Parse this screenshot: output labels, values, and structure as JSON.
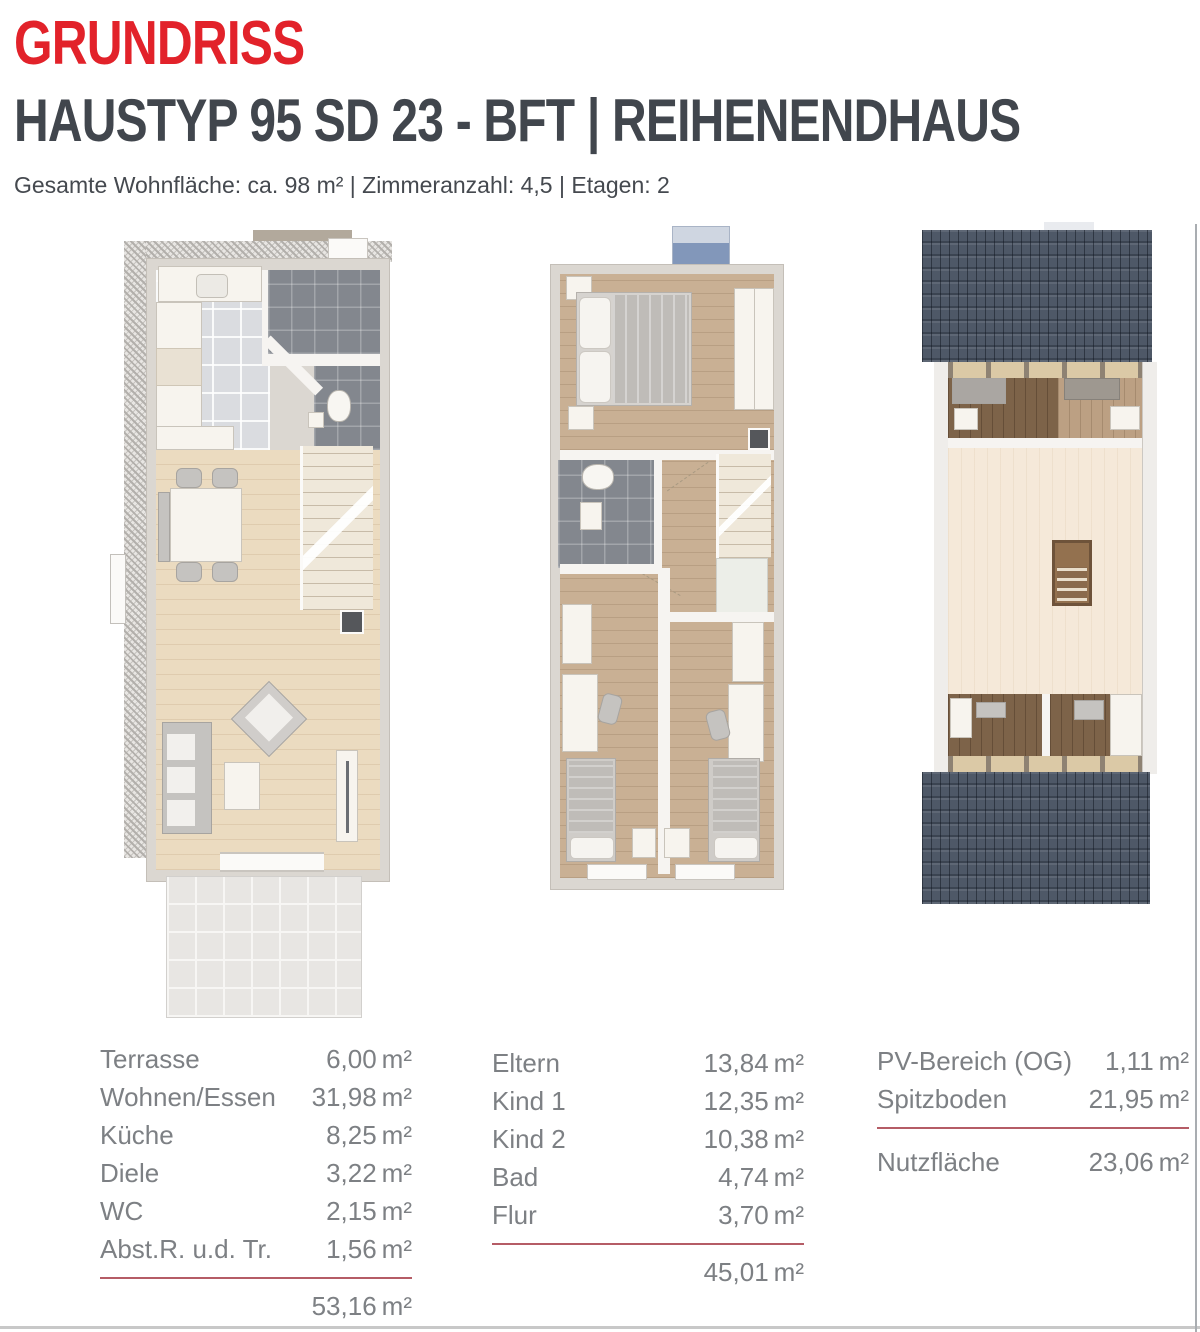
{
  "header": {
    "eyebrow": "GRUNDRISS",
    "title": "HAUSTYP 95 SD 23 - BFT | REIHENENDHAUS",
    "meta": "Gesamte Wohnfläche: ca. 98 m² | Zimmeranzahl: 4,5 | Etagen: 2"
  },
  "unit": "m²",
  "colors": {
    "accent_red": "#e2222a",
    "title_gray": "#41464d",
    "table_text": "#7d8084",
    "rule_red": "#b55c66",
    "roof_blue_gray": "#4e5867",
    "wood_light": "#ebdbc0",
    "wood_medium": "#c9b094",
    "tile_dark": "#83878e"
  },
  "tables": {
    "erdgeschoss": {
      "rows": [
        {
          "label": "Terrasse",
          "value": "6,00"
        },
        {
          "label": "Wohnen/Essen",
          "value": "31,98"
        },
        {
          "label": "Küche",
          "value": "8,25"
        },
        {
          "label": "Diele",
          "value": "3,22"
        },
        {
          "label": "WC",
          "value": "2,15"
        },
        {
          "label": "Abst.R. u.d. Tr.",
          "value": "1,56"
        }
      ],
      "total_value": "53,16"
    },
    "obergeschoss": {
      "rows": [
        {
          "label": "Eltern",
          "value": "13,84"
        },
        {
          "label": "Kind 1",
          "value": "12,35"
        },
        {
          "label": "Kind 2",
          "value": "10,38"
        },
        {
          "label": "Bad",
          "value": "4,74"
        },
        {
          "label": "Flur",
          "value": "3,70"
        }
      ],
      "total_value": "45,01"
    },
    "dachgeschoss": {
      "rows": [
        {
          "label": "PV-Bereich (OG)",
          "value": "1,11"
        },
        {
          "label": "Spitzboden",
          "value": "21,95"
        }
      ],
      "total_label": "Nutzfläche",
      "total_value": "23,06"
    }
  }
}
